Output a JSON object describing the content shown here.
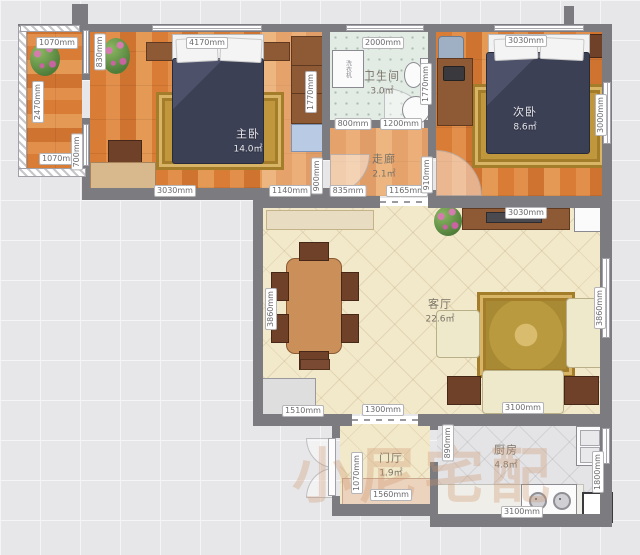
{
  "rooms": [
    {
      "name": "主卧",
      "area": "14.0㎡"
    },
    {
      "name": "次卧",
      "area": "8.6㎡"
    },
    {
      "name": "卫生间",
      "area": "3.0㎡"
    },
    {
      "name": "走廊",
      "area": "2.1㎡"
    },
    {
      "name": "客厅",
      "area": "22.6㎡"
    },
    {
      "name": "门厅",
      "area": "1.9㎡"
    },
    {
      "name": "厨房",
      "area": "4.8㎡"
    }
  ],
  "appliances": {
    "washing_machine": "洗衣机"
  },
  "watermark": "小尼宅配",
  "dims": {
    "balcony_top": "1070mm",
    "balcony_left": "2470mm",
    "balcony_bottom": "1070mm",
    "balcony_wall": "700mm",
    "balcony_door": "830mm",
    "master_top": "4170mm",
    "master_bottom": "3030mm",
    "master_wardrobe": "1770mm",
    "master_door": "900mm",
    "bath_top": "2000mm",
    "bath_bottom_left": "800mm",
    "bath_bottom_right": "1200mm",
    "bath_right": "1770mm",
    "corridor_left": "1140mm",
    "corridor_mid": "835mm",
    "corridor_right": "1165mm",
    "second_door": "910mm",
    "second_top": "3030mm",
    "second_right": "3000mm",
    "living_top": "3030mm",
    "living_left": "3860mm",
    "living_right": "3860mm",
    "living_sofa": "3100mm",
    "living_bottom_left": "1510mm",
    "living_opening": "1300mm",
    "hall_left": "1070mm",
    "hall_cabinet": "1560mm",
    "kitchen_door": "890mm",
    "kitchen_right": "1800mm",
    "kitchen_bottom": "3100mm"
  },
  "palette": {
    "wall": "#7b7b80",
    "wood_floor": "#d9813f",
    "bath_tile": "#e2ece5",
    "living_floor": "#f2e8ca",
    "kitchen_floor": "#e4e4e6",
    "bed": "#3c4054",
    "rug": "#c0973c",
    "sofa": "#efe9cc",
    "watermark": "#cd9470"
  }
}
